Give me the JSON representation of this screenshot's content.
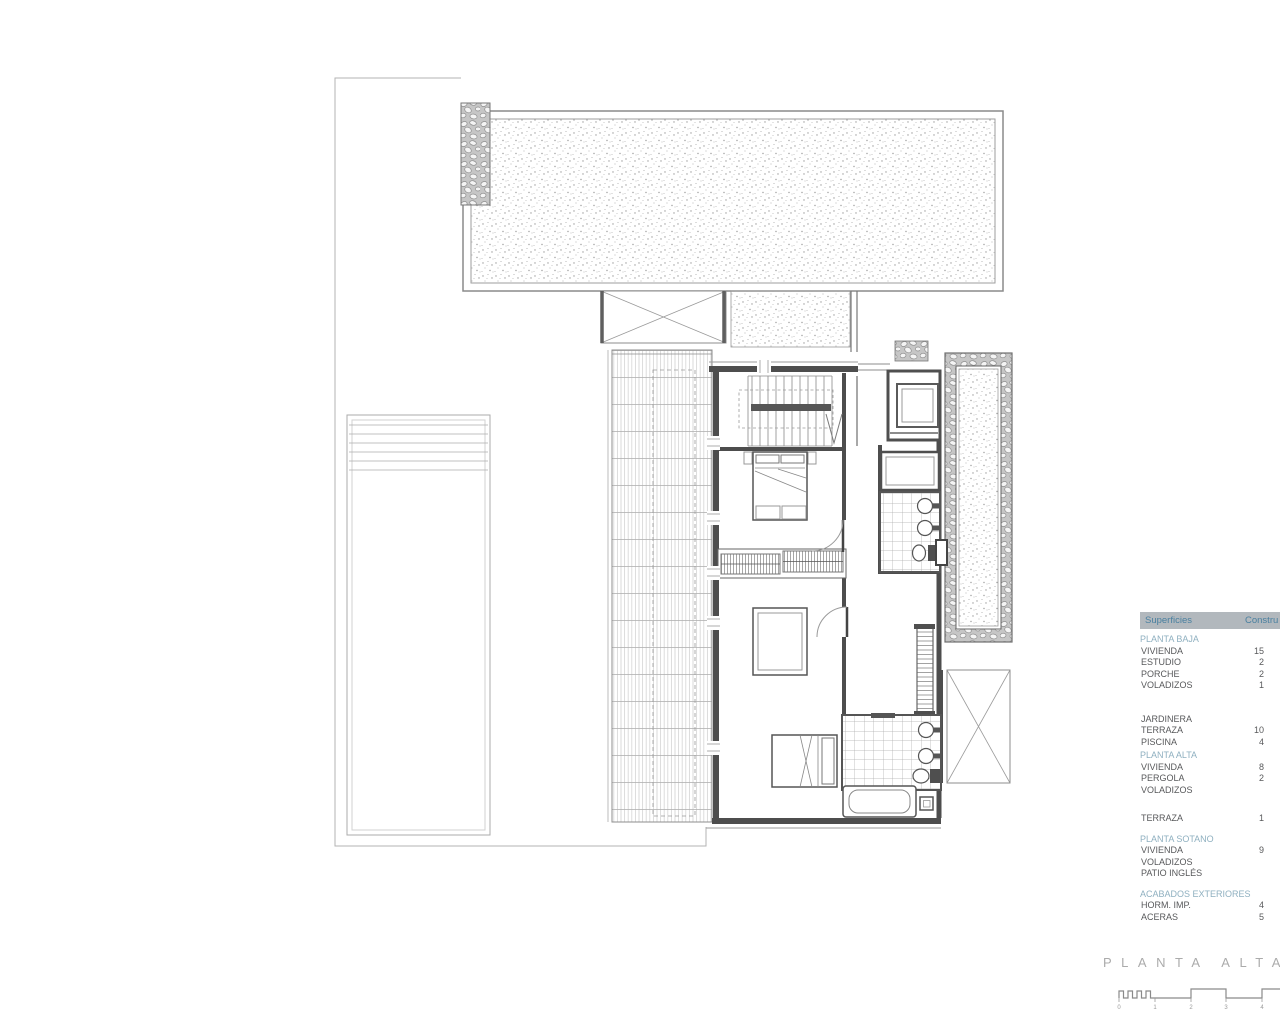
{
  "drawing": {
    "title": "PLANTA ALTA"
  },
  "scalebar": {
    "labels": [
      "0",
      "1",
      "2",
      "3",
      "4"
    ]
  },
  "areas_table": {
    "header": {
      "col1": "Superficies",
      "col2": "Constru"
    },
    "rows": [
      {
        "t": "sec",
        "label": "PLANTA BAJA"
      },
      {
        "t": "row",
        "label": "VIVIENDA",
        "value": "15"
      },
      {
        "t": "row",
        "label": "ESTUDIO",
        "value": "2"
      },
      {
        "t": "row",
        "label": "PORCHE",
        "value": "2"
      },
      {
        "t": "row",
        "label": "VOLADIZOS",
        "value": "1"
      },
      {
        "t": "gap",
        "h": 22
      },
      {
        "t": "row",
        "label": "JARDINERA",
        "value": ""
      },
      {
        "t": "row",
        "label": "TERRAZA",
        "value": "10"
      },
      {
        "t": "row",
        "label": "PISCINA",
        "value": "4"
      },
      {
        "t": "sec",
        "label": "PLANTA ALTA"
      },
      {
        "t": "row",
        "label": "VIVIENDA",
        "value": "8"
      },
      {
        "t": "row",
        "label": "PERGOLA",
        "value": "2"
      },
      {
        "t": "row",
        "label": "VOLADIZOS",
        "value": ""
      },
      {
        "t": "gap",
        "h": 17
      },
      {
        "t": "row",
        "label": "TERRAZA",
        "value": "1"
      },
      {
        "t": "gap",
        "h": 7
      },
      {
        "t": "sec",
        "label": "PLANTA SOTANO"
      },
      {
        "t": "row",
        "label": "VIVIENDA",
        "value": "9"
      },
      {
        "t": "row",
        "label": "VOLADIZOS",
        "value": ""
      },
      {
        "t": "row",
        "label": "PATIO INGLÉS",
        "value": ""
      },
      {
        "t": "gap",
        "h": 7
      },
      {
        "t": "sec",
        "label": "ACABADOS EXTERIORES"
      },
      {
        "t": "row",
        "label": "HORM. IMP.",
        "value": "4"
      },
      {
        "t": "row",
        "label": "ACERAS",
        "value": "5"
      }
    ]
  },
  "colors": {
    "accent_teal": "#4a80a0",
    "section_teal": "#8fb0c0",
    "row_text": "#58595b",
    "table_header_bg": "#b2b8bd",
    "line_gray": "#8a8a8a",
    "wall_dark": "#4d4d4d",
    "title_gray": "#ababab"
  }
}
